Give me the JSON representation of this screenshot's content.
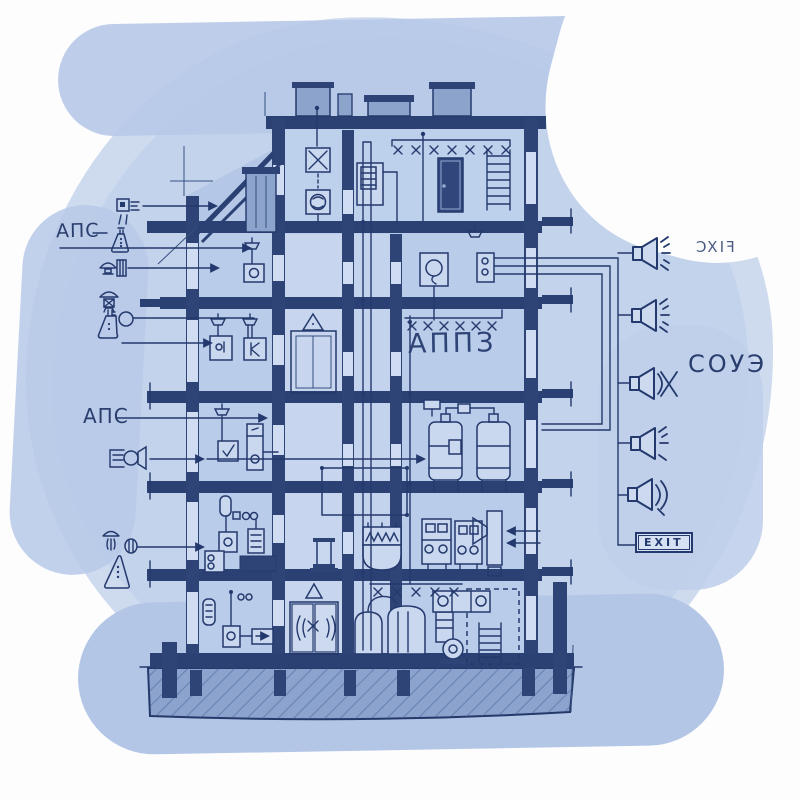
{
  "labels": {
    "aps_upper": "АПС",
    "aps_lower": "АПС",
    "appz": "АППЗ",
    "souye": "СОУЭ",
    "fix_mirrored": "FIXC",
    "exit": "EXIT"
  },
  "legend": {
    "items": [
      {
        "icon": "smoke-detector-icon"
      },
      {
        "icon": "manual-call-point-flask-icon"
      },
      {
        "icon": "hydrant-mushroom-icon"
      },
      {
        "icon": "ceiling-lamp-icon"
      },
      {
        "icon": "flask-and-gauge-icon"
      },
      {
        "icon": "horn-sounder-icon"
      },
      {
        "icon": "sprinkler-spray-icon"
      },
      {
        "icon": "warning-triangle-icon"
      }
    ]
  },
  "speakers": {
    "count": 5,
    "icons": [
      "loudspeaker-rays-icon",
      "loudspeaker-rays-icon",
      "loudspeaker-crossed-waves-icon",
      "loudspeaker-rays-icon",
      "loudspeaker-waves-icon"
    ]
  },
  "colors": {
    "ink": "#24396d",
    "wall": "#2e4476",
    "room": "#b9cce9",
    "wash": "#c3d3ec",
    "ground": "#8ba3cd"
  }
}
